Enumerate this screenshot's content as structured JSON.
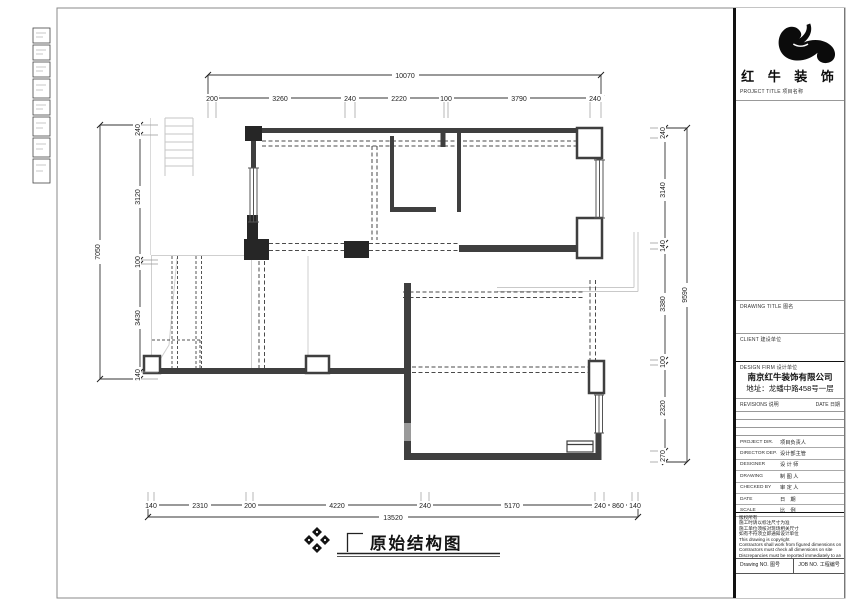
{
  "sheet": {
    "drawing_title": "原始结构图"
  },
  "dims": {
    "top_total": "10070",
    "top": [
      "200",
      "3260",
      "240",
      "2220",
      "100",
      "3790",
      "240"
    ],
    "left_total": "7050",
    "left": [
      "240",
      "3120",
      "100",
      "3430",
      "140"
    ],
    "right_total": "9590",
    "right": [
      "240",
      "3140",
      "140",
      "3380",
      "100",
      "2320",
      "270"
    ],
    "bottom_total": "13520",
    "bottom": [
      "140",
      "2310",
      "200",
      "4220",
      "240",
      "5170",
      "240",
      "860",
      "140"
    ]
  },
  "title_block": {
    "brand": "红 牛 装 饰",
    "project_title_label": "PROJECT TITLE 项目名称",
    "drawing_title_label": "DRAWING TITLE 图名",
    "client_label": "CLIENT 建设单位",
    "design_firm_label": "DESIGN FIRM 设计单位",
    "company_name": "南京红牛装饰有限公司",
    "company_address": "地址：龙蟠中路458号一层",
    "revisions_label": "REVISIONS 说明",
    "revisions_date_label": "DATE 日期",
    "rows": [
      {
        "en": "PROJECT DIR.",
        "zh": "项目负责人"
      },
      {
        "en": "DIRECTOR DEP.",
        "zh": "设计部主管"
      },
      {
        "en": "DESIGNER",
        "zh": "设 计 师"
      },
      {
        "en": "DRAWING",
        "zh": "制 图 人"
      },
      {
        "en": "CHECKED BY",
        "zh": "审 定 人"
      },
      {
        "en": "DATE",
        "zh": "日　期"
      },
      {
        "en": "SCALE",
        "zh": "比　例"
      }
    ],
    "notes": [
      "版权所有",
      "施工时请以标注尺寸为准",
      "施工单位须核对现场相关尺寸",
      "如有不符须立即通知设计单位",
      "This drawing is copyright",
      "Contractors shall work from figured dimensions only",
      "Contractors must check all dimensions on site",
      "Discrepancies must be reported immediately to architects"
    ],
    "drawing_no_label": "Drawing NO. 图号",
    "job_no_label": "JOB NO. 工程编号"
  }
}
